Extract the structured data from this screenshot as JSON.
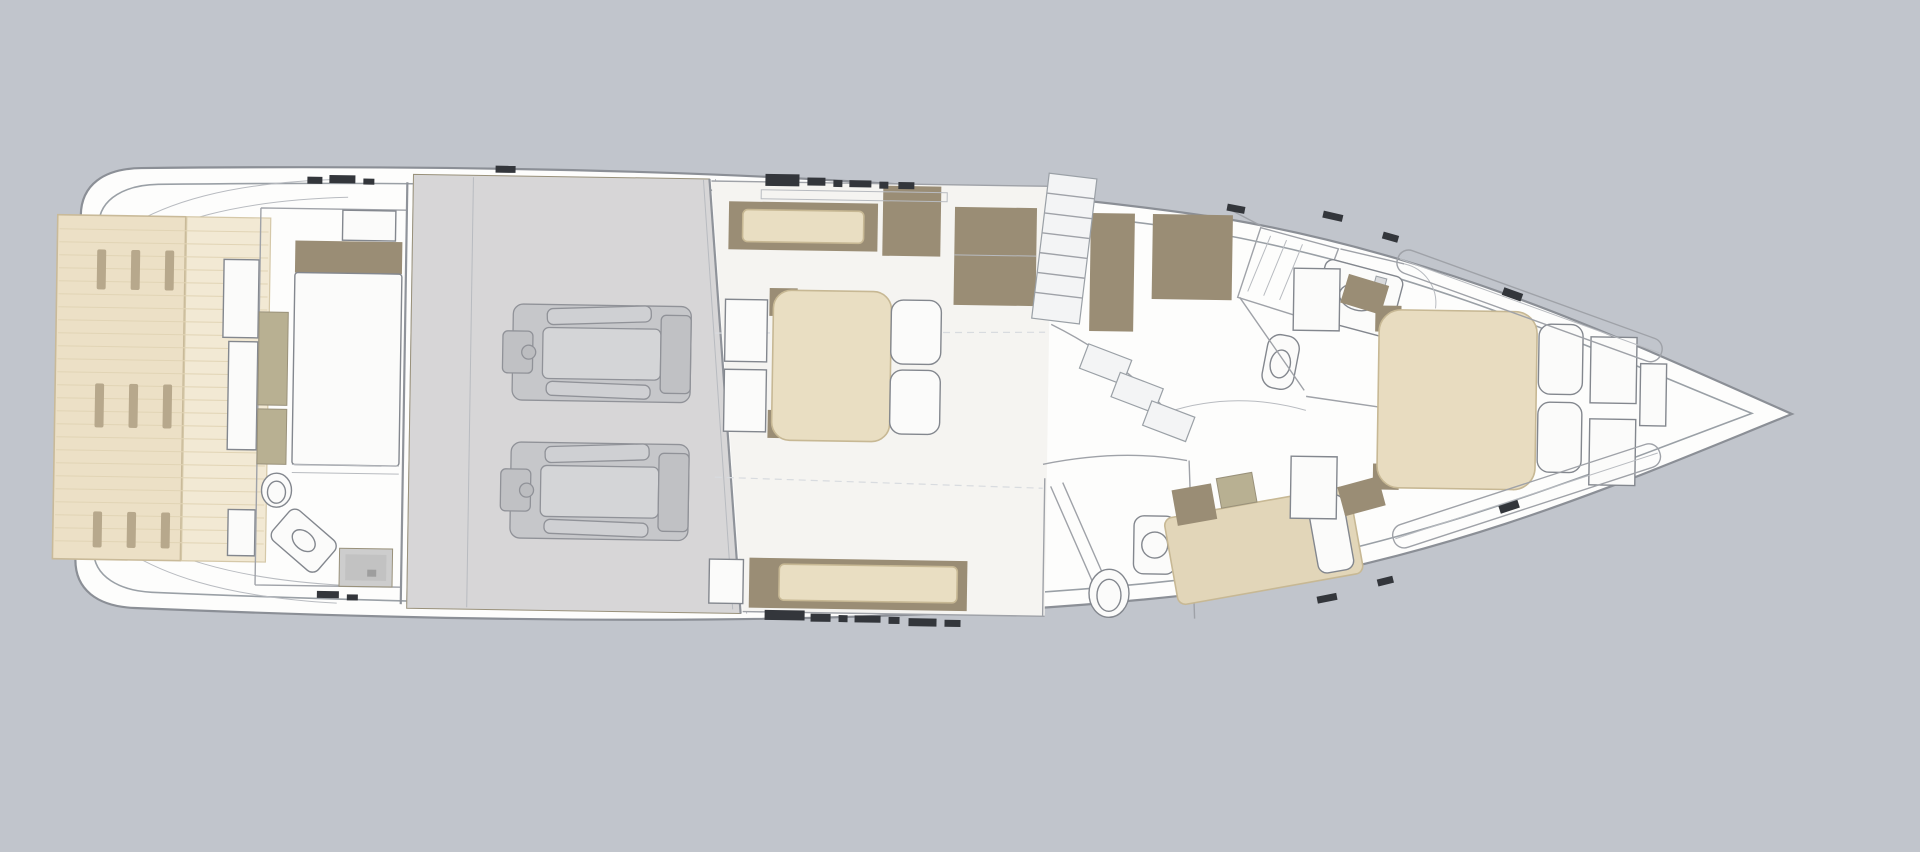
{
  "diagram": {
    "type": "floor-plan",
    "subject": "motor-yacht lower deck layout, side profile top view, bow to the right",
    "regions": [
      {
        "name": "swim-platform",
        "features": [
          "teak-planks",
          "deck-slats"
        ]
      },
      {
        "name": "aft-crew-cabin",
        "features": [
          "berth",
          "headboard",
          "wardrobe",
          "toilet",
          "sink",
          "shower"
        ]
      },
      {
        "name": "engine-room",
        "features": [
          "port-engine",
          "starboard-engine"
        ]
      },
      {
        "name": "master-cabin",
        "features": [
          "double-berth",
          "pillows",
          "sofa-port",
          "sofa-starboard",
          "wardrobes",
          "nightstands"
        ]
      },
      {
        "name": "companionway-stairs",
        "features": [
          "steps"
        ]
      },
      {
        "name": "day-head",
        "features": [
          "toilet",
          "sink",
          "shower-glass"
        ]
      },
      {
        "name": "guest-cabin",
        "features": [
          "single-berth",
          "pillow"
        ]
      },
      {
        "name": "forward-bathroom",
        "features": [
          "shower",
          "vanity-sink",
          "toilet",
          "wardrobe"
        ]
      },
      {
        "name": "vip-forward-cabin",
        "features": [
          "double-berth",
          "pillows",
          "nightstands",
          "side-lockers",
          "bow-locker"
        ]
      }
    ]
  },
  "colors": {
    "background": "#c1c5cc",
    "hull_fill": "#fdfdfc",
    "teak": "#ece0c6",
    "teak_light": "#f2e9d4",
    "teak_slat": "#b7a88c",
    "wood_brown": "#9a8d75",
    "khaki": "#b8b092",
    "cushion": "#e9dec2",
    "cushion_guest": "#e2d6b9",
    "cushion_vip": "#e8dcc0",
    "floor": "#f5f4f1",
    "engine_floor": "#d7d6d7",
    "engine_body": "#c6c7ca",
    "engine_inner": "#d4d5d7",
    "shower_floor": "#cdcdcd",
    "dark_mark": "#33363b"
  }
}
